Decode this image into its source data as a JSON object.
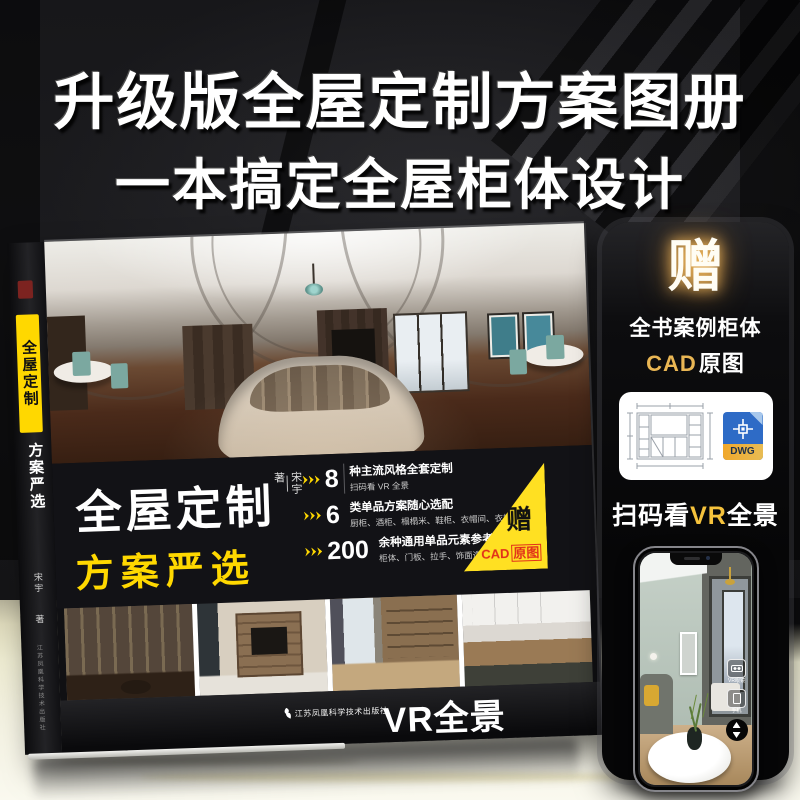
{
  "headline": {
    "line1": "升级版全屋定制方案图册",
    "line2": "一本搞定全屋柜体设计"
  },
  "book": {
    "spine": {
      "title": "全屋定制",
      "subtitle": "方案严选",
      "author": "宋宇",
      "author_suffix": "著",
      "publisher": "江苏凤凰科学技术出版社"
    },
    "cover": {
      "title": "全屋定制",
      "author": "宋宇",
      "author_suffix": "著",
      "subtitle": "方案严选",
      "bullets": [
        {
          "number": "8",
          "title": "种主流风格全套定制",
          "desc": "扫码看 VR 全景"
        },
        {
          "number": "6",
          "title": "类单品方案随心选配",
          "desc": "厨柜、酒柜、榻榻米、鞋柜、衣帽间、衣柜"
        },
        {
          "number": "200",
          "title": "余种通用单品元素参考",
          "desc": "柜体、门板、拉手、饰面造型一目了然"
        }
      ],
      "badge": {
        "gift": "赠",
        "cad": "CAD",
        "cad_suffix": "原图"
      },
      "publisher": "江苏凤凰科学技术出版社",
      "vr_label": "VR全景"
    }
  },
  "panel": {
    "gift": "赠",
    "line1": "全书案例柜体",
    "cad": "CAD",
    "cad_suffix": "原图",
    "dwg_label": "DWG",
    "scan": {
      "prefix": "扫码看",
      "vr": "VR",
      "suffix": "全景"
    },
    "phone_icons": [
      {
        "label": "VR眼镜"
      },
      {
        "label": "手机"
      }
    ]
  },
  "colors": {
    "accent_yellow": "#ffd800",
    "badge_yellow": "#ffe022",
    "badge_red": "#e2301a",
    "cad_gold": "#e9b654",
    "dwg_blue": "#2e6bc6",
    "dwg_band": "#f0a82c",
    "floor": "#efecd2"
  }
}
